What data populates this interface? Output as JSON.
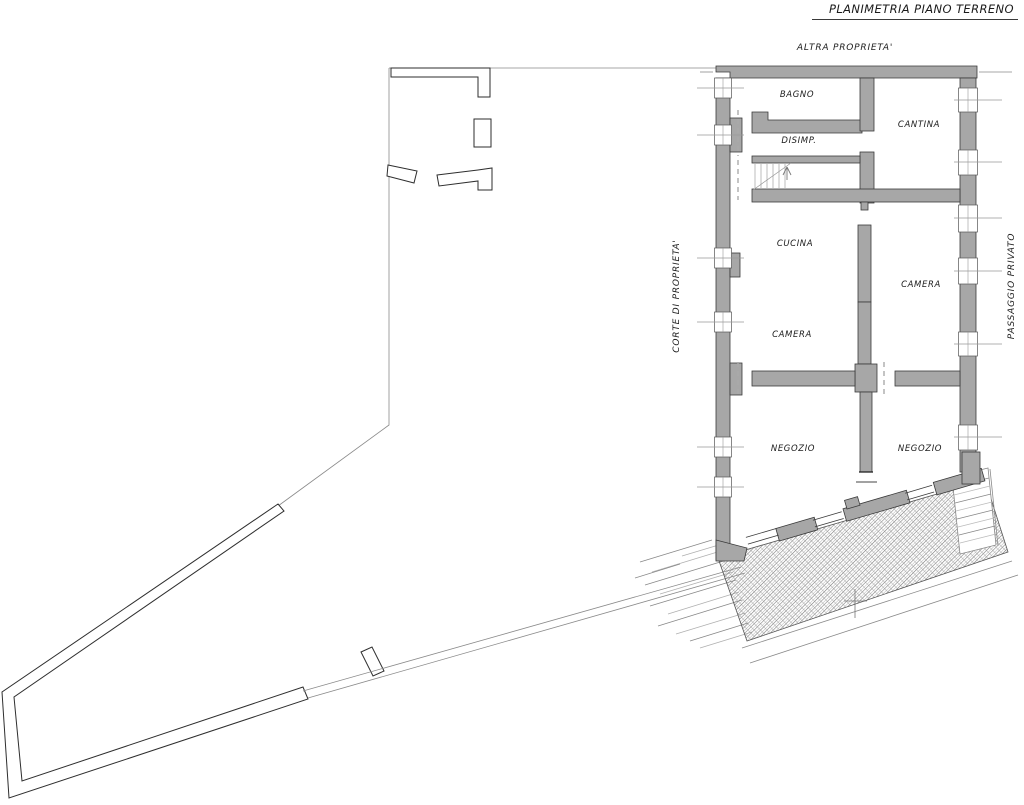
{
  "title": "PLANIMETRIA PIANO TERRENO",
  "annotations": {
    "top": "ALTRA PROPRIETA'",
    "left": "CORTE DI PROPRIETA'",
    "right": "PASSAGGIO PRIVATO"
  },
  "rooms": [
    {
      "label": "BAGNO"
    },
    {
      "label": "DISIMP."
    },
    {
      "label": "CANTINA"
    },
    {
      "label": "CUCINA"
    },
    {
      "label": "CAMERA"
    },
    {
      "label": "CAMERA"
    },
    {
      "label": "NEGOZIO"
    },
    {
      "label": "NEGOZIO"
    }
  ],
  "colors": {
    "wall_fill": "#a7a7a7",
    "wall_stroke": "#3a3a3a",
    "thin_line": "#8a8a8a",
    "dark_line": "#2e2e2e",
    "text": "#1c1c1c",
    "background": "#ffffff"
  }
}
